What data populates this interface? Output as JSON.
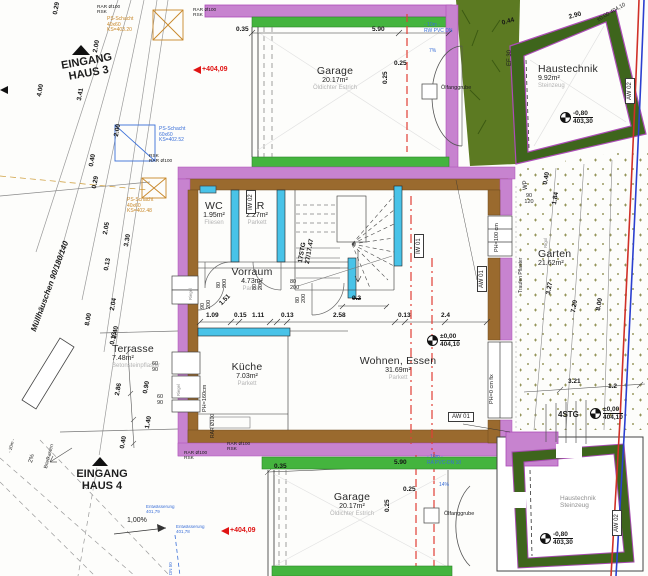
{
  "colors": {
    "wall_purple": "#c783cf",
    "wall_purple_edge": "#ad4cb8",
    "wall_brown": "#9a6a2e",
    "wall_green": "#44b43e",
    "wall_darkgreen": "#3e651c",
    "hedge_green": "#5c7a22",
    "interior_cyan": "#49c3e8",
    "marking_red": "#e23f35",
    "pipe_blue": "#3a6fd8",
    "shaft_orange": "#c8882a",
    "flag_red": "#e01414",
    "boundary_red": "#d03028",
    "boundary_blue": "#2b3fd0"
  },
  "rooms": [
    {
      "name": "Garage",
      "area": "20.17m²",
      "material": "Öldichter Estrich",
      "x": 335,
      "y": 66,
      "align": "center"
    },
    {
      "name": "Haustechnik",
      "area": "9.92m²",
      "material": "Steinzeug",
      "x": 538,
      "y": 64,
      "align": "left"
    },
    {
      "name": "WC",
      "area": "1.95m²",
      "material": "Fliesen",
      "x": 214,
      "y": 201,
      "align": "center"
    },
    {
      "name": "AR",
      "area": "2.27m²",
      "material": "Parkett",
      "x": 257,
      "y": 201,
      "align": "center"
    },
    {
      "name": "Vorraum",
      "area": "4.73m²",
      "material": "Parkett",
      "x": 252,
      "y": 267,
      "align": "center"
    },
    {
      "name": "Küche",
      "area": "7.03m²",
      "material": "Parkett",
      "x": 247,
      "y": 362,
      "align": "center"
    },
    {
      "name": "Wohnen, Essen",
      "area": "31.69m²",
      "material": "Parkett",
      "x": 398,
      "y": 356,
      "align": "center"
    },
    {
      "name": "Terrasse",
      "area": "7.48m²",
      "material": "Betonsteinpflaster",
      "x": 112,
      "y": 344,
      "align": "left"
    },
    {
      "name": "Garten",
      "area": "21.62m²",
      "material": "",
      "x": 538,
      "y": 249,
      "align": "left"
    },
    {
      "name": "Garage",
      "area": "20.17m²",
      "material": "Öldichter Estrich",
      "x": 352,
      "y": 492,
      "align": "center"
    }
  ],
  "dimensions": [
    {
      "t": "0.35",
      "x": 236,
      "y": 26
    },
    {
      "t": "5.90",
      "x": 372,
      "y": 26
    },
    {
      "t": "0.25",
      "x": 394,
      "y": 60
    },
    {
      "t": "0.25",
      "x": 382,
      "y": 84,
      "r": -90
    },
    {
      "t": "2.90",
      "x": 568,
      "y": 14,
      "r": -16
    },
    {
      "t": "0.44",
      "x": 501,
      "y": 20,
      "r": -16
    },
    {
      "t": "0.29",
      "x": 52,
      "y": 14,
      "r": -80
    },
    {
      "t": "2.00",
      "x": 92,
      "y": 52,
      "r": -80
    },
    {
      "t": "4.00",
      "x": 36,
      "y": 96,
      "r": -80
    },
    {
      "t": "3.41",
      "x": 76,
      "y": 100,
      "r": -80
    },
    {
      "t": "2.00",
      "x": 113,
      "y": 136,
      "r": -80
    },
    {
      "t": "0.40",
      "x": 88,
      "y": 166,
      "r": -80
    },
    {
      "t": "0.29",
      "x": 91,
      "y": 188,
      "r": -80
    },
    {
      "t": "2.05",
      "x": 102,
      "y": 234,
      "r": -80
    },
    {
      "t": "3.30",
      "x": 123,
      "y": 246,
      "r": -80
    },
    {
      "t": "0.13",
      "x": 103,
      "y": 270,
      "r": -80
    },
    {
      "t": "2.04",
      "x": 109,
      "y": 310,
      "r": -80
    },
    {
      "t": "8.00",
      "x": 84,
      "y": 325,
      "r": -80
    },
    {
      "t": "2.40",
      "x": 111,
      "y": 338,
      "r": -80
    },
    {
      "t": "0.13",
      "x": 109,
      "y": 344,
      "r": -80
    },
    {
      "t": "2.86",
      "x": 114,
      "y": 395,
      "r": -80
    },
    {
      "t": "0.90",
      "x": 142,
      "y": 393,
      "r": -80
    },
    {
      "t": "1.40",
      "x": 144,
      "y": 428,
      "r": -80
    },
    {
      "t": "0.40",
      "x": 119,
      "y": 448,
      "r": -80
    },
    {
      "t": "1.09",
      "x": 206,
      "y": 312
    },
    {
      "t": "0.15",
      "x": 234,
      "y": 312
    },
    {
      "t": "1.11",
      "x": 252,
      "y": 312
    },
    {
      "t": "0.13",
      "x": 281,
      "y": 312
    },
    {
      "t": "2.58",
      "x": 333,
      "y": 312
    },
    {
      "t": "0.13",
      "x": 398,
      "y": 312
    },
    {
      "t": "2.4",
      "x": 441,
      "y": 312
    },
    {
      "t": "1.51",
      "x": 218,
      "y": 302,
      "r": -45
    },
    {
      "t": "9.2",
      "x": 352,
      "y": 295,
      "strike": true
    },
    {
      "t": "0.40",
      "x": 542,
      "y": 184,
      "r": -80
    },
    {
      "t": "1.84",
      "x": 551,
      "y": 204,
      "r": -80
    },
    {
      "t": "3.27",
      "x": 545,
      "y": 294,
      "r": -80
    },
    {
      "t": "7.20",
      "x": 570,
      "y": 312,
      "r": -80
    },
    {
      "t": "8.00",
      "x": 595,
      "y": 310,
      "r": -80
    },
    {
      "t": "3.21",
      "x": 568,
      "y": 378
    },
    {
      "t": "1.2",
      "x": 608,
      "y": 383
    },
    {
      "t": "0.35",
      "x": 274,
      "y": 463
    },
    {
      "t": "5.90",
      "x": 394,
      "y": 459
    },
    {
      "t": "0.25",
      "x": 403,
      "y": 486
    },
    {
      "t": "0.25",
      "x": 384,
      "y": 512,
      "r": -90
    }
  ],
  "annotations": [
    {
      "lines": [
        "RAR Ø100",
        "RSK"
      ],
      "x": 97,
      "y": 5,
      "size": 4.8
    },
    {
      "lines": [
        "RAR Ø100",
        "RSK"
      ],
      "x": 193,
      "y": 8,
      "size": 4.8
    },
    {
      "lines": [
        "RSK",
        "RAR Ø100"
      ],
      "x": 149,
      "y": 154,
      "size": 4.8
    },
    {
      "lines": [
        "PS-Schacht",
        "40x60",
        "KS=403.20"
      ],
      "x": 107,
      "y": 17,
      "size": 5,
      "color": "#c8882a"
    },
    {
      "lines": [
        "PS-Schacht",
        "60x60",
        "KS=402.52"
      ],
      "x": 159,
      "y": 127,
      "size": 5,
      "color": "#3a6fd8"
    },
    {
      "lines": [
        "PS-Schacht",
        "40x60",
        "KS=402.48"
      ],
      "x": 127,
      "y": 198,
      "size": 5,
      "color": "#c8882a"
    },
    {
      "lines": [
        "- 10m -",
        "RW PVC DN"
      ],
      "x": 424,
      "y": 23,
      "size": 5,
      "color": "#3a6fd8"
    },
    {
      "lines": [
        "7%"
      ],
      "x": 429,
      "y": 49,
      "size": 5,
      "color": "#3a6fd8"
    },
    {
      "lines": [
        "EINGANG",
        "HAUS 3"
      ],
      "x": 86,
      "y": 60,
      "size": 11,
      "bold": 1,
      "align": "center",
      "rot": -10
    },
    {
      "lines": [
        "Müllhäuschen 90/180/140"
      ],
      "x": 30,
      "y": 330,
      "size": 8,
      "bold": 1,
      "it": 1,
      "rot": -70
    },
    {
      "lines": [
        "EF 30"
      ],
      "x": 507,
      "y": 66,
      "size": 6,
      "rot": -90
    },
    {
      "lines": [
        "WP"
      ],
      "x": 523,
      "y": 190,
      "size": 6,
      "rot": -90
    },
    {
      "lines": [
        "±0,00  404,10"
      ],
      "x": 596,
      "y": 18,
      "size": 5.5,
      "rot": -30
    },
    {
      "lines": [
        "17STG",
        "27/17.47"
      ],
      "x": 297,
      "y": 262,
      "size": 6.5,
      "bold": 1,
      "rot": -80
    },
    {
      "lines": [
        "80",
        "200"
      ],
      "x": 216,
      "y": 288,
      "size": 5.5,
      "rot": -90
    },
    {
      "lines": [
        "80",
        "200"
      ],
      "x": 252,
      "y": 290,
      "size": 5.5,
      "rot": -90
    },
    {
      "lines": [
        "90",
        "200"
      ],
      "x": 200,
      "y": 309,
      "size": 5.5,
      "rot": -90
    },
    {
      "lines": [
        "80",
        "200"
      ],
      "x": 295,
      "y": 303,
      "size": 5.5,
      "rot": -90
    },
    {
      "lines": [
        "80",
        "200"
      ],
      "x": 290,
      "y": 279,
      "size": 5.5
    },
    {
      "lines": [
        "Riegel"
      ],
      "x": 189,
      "y": 300,
      "size": 4.2,
      "rot": -90,
      "color": "#8a8a8a"
    },
    {
      "lines": [
        "Riegel"
      ],
      "x": 177,
      "y": 396,
      "size": 4.2,
      "rot": -90,
      "color": "#8a8a8a"
    },
    {
      "lines": [
        "Ölfanggrube"
      ],
      "x": 441,
      "y": 85,
      "size": 5.5
    },
    {
      "lines": [
        "Ölfanggrube"
      ],
      "x": 444,
      "y": 511,
      "size": 5.5
    },
    {
      "lines": [
        "PH=100 cm"
      ],
      "x": 494,
      "y": 252,
      "size": 5.5,
      "rot": -90
    },
    {
      "lines": [
        "Traufen Pflaster"
      ],
      "x": 519,
      "y": 293,
      "size": 5,
      "rot": -90
    },
    {
      "lines": [
        "Rigol"
      ],
      "x": 543,
      "y": 248,
      "size": 4.5,
      "rot": -90,
      "color": "#8a8a8a"
    },
    {
      "lines": [
        "PH=0 cm fix"
      ],
      "x": 489,
      "y": 404,
      "size": 5.5,
      "rot": -90
    },
    {
      "lines": [
        "PH=160cm"
      ],
      "x": 202,
      "y": 412,
      "size": 5.5,
      "rot": -90
    },
    {
      "lines": [
        "RAR Ø100"
      ],
      "x": 211,
      "y": 438,
      "size": 5,
      "rot": -90
    },
    {
      "lines": [
        "60",
        "90"
      ],
      "x": 155,
      "y": 361,
      "size": 5.5,
      "align": "center"
    },
    {
      "lines": [
        "60",
        "90"
      ],
      "x": 160,
      "y": 394,
      "size": 5.5,
      "align": "center"
    },
    {
      "lines": [
        "90",
        "120"
      ],
      "x": 529,
      "y": 193,
      "size": 5.5,
      "align": "center"
    },
    {
      "lines": [
        "RAR Ø100",
        "RSK"
      ],
      "x": 184,
      "y": 451,
      "size": 4.8
    },
    {
      "lines": [
        "RAR Ø100",
        "RSK"
      ],
      "x": 227,
      "y": 442,
      "size": 4.8
    },
    {
      "lines": [
        "EINGANG",
        "HAUS 4"
      ],
      "x": 102,
      "y": 468,
      "size": 11,
      "bold": 1,
      "align": "center"
    },
    {
      "lines": [
        "Briefkasten"
      ],
      "x": 44,
      "y": 468,
      "size": 5,
      "rot": -75
    },
    {
      "lines": [
        "2%"
      ],
      "x": 28,
      "y": 462,
      "size": 6,
      "rot": -75
    },
    {
      "lines": [
        "- 20m -"
      ],
      "x": 7,
      "y": 452,
      "size": 4.5,
      "rot": -75
    },
    {
      "lines": [
        "1,00%"
      ],
      "x": 127,
      "y": 517,
      "size": 7
    },
    {
      "lines": [
        "Entwässerung",
        "401,79"
      ],
      "x": 146,
      "y": 504,
      "size": 4.5,
      "color": "#3a6fd8"
    },
    {
      "lines": [
        "Entwässerung",
        "401,78"
      ],
      "x": 176,
      "y": 524,
      "size": 4.5,
      "color": "#3a6fd8"
    },
    {
      "lines": [
        "- 10m -",
        "RA PVC-DN 10"
      ],
      "x": 427,
      "y": 455,
      "size": 5,
      "color": "#3a6fd8"
    },
    {
      "lines": [
        "14%"
      ],
      "x": 439,
      "y": 483,
      "size": 5,
      "color": "#3a6fd8"
    },
    {
      "lines": [
        "4STG"
      ],
      "x": 558,
      "y": 411,
      "size": 8,
      "bold": 1
    },
    {
      "lines": [
        "Haustechnik",
        "Steinzeug"
      ],
      "x": 560,
      "y": 495,
      "size": 6.5,
      "color": "#909090"
    },
    {
      "lines": [
        "DN 50"
      ],
      "x": 168,
      "y": 575,
      "size": 4.5,
      "rot": -90,
      "color": "#3a6fd8"
    }
  ],
  "boxed_labels": [
    {
      "text": "IW 02",
      "x": 246,
      "y": 214,
      "rot": -90
    },
    {
      "text": "IW 01",
      "x": 414,
      "y": 258,
      "rot": -90
    },
    {
      "text": "AW 01",
      "x": 477,
      "y": 292,
      "rot": -90
    },
    {
      "text": "AW 02",
      "x": 625,
      "y": 104,
      "rot": -90
    },
    {
      "text": "AW 01",
      "x": 448,
      "y": 412
    },
    {
      "text": "AW 02",
      "x": 612,
      "y": 536,
      "rot": -90
    }
  ],
  "level_markers": [
    {
      "value": "±0,00",
      "elevation": "404,10",
      "x": 427,
      "y": 333
    },
    {
      "value": "-0,80",
      "elevation": "403,30",
      "x": 560,
      "y": 110
    },
    {
      "value": "±0,00",
      "elevation": "404,10",
      "x": 590,
      "y": 406
    },
    {
      "value": "-0,80",
      "elevation": "403,30",
      "x": 540,
      "y": 531
    }
  ],
  "elevation_flags": [
    {
      "text": "+404,09",
      "x": 193,
      "y": 66
    },
    {
      "text": "+404,09",
      "x": 221,
      "y": 527
    }
  ]
}
